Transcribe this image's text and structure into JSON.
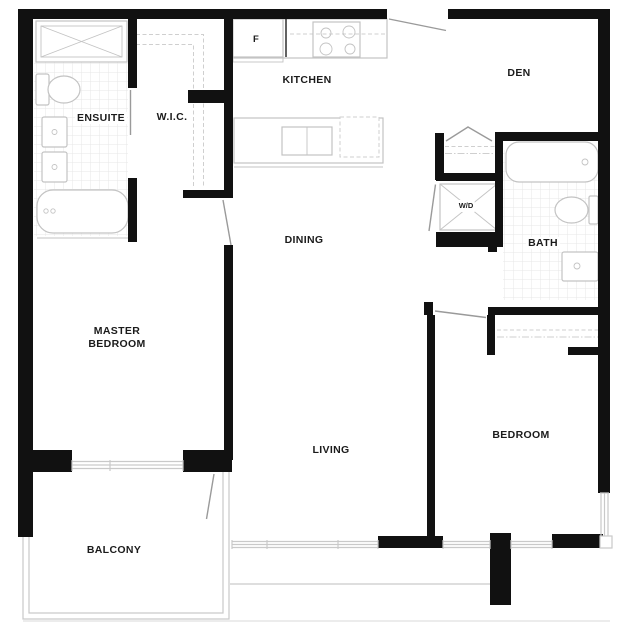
{
  "rooms": {
    "ensuite": "ENSUITE",
    "wic": "W.I.C.",
    "kitchen": "KITCHEN",
    "den": "DEN",
    "dining": "DINING",
    "bath": "BATH",
    "master_bedroom_line1": "MASTER",
    "master_bedroom_line2": "BEDROOM",
    "living": "LIVING",
    "bedroom": "BEDROOM",
    "balcony": "BALCONY"
  },
  "appliances": {
    "fridge": "F",
    "washer_dryer": "W/D"
  },
  "colors": {
    "wall": "#111111",
    "fixture": "#c3c3c3",
    "door": "#9a9a9a",
    "dash": "#cfcfcf",
    "tile": "#e7e7e7",
    "label": "#1b1b1b",
    "window": "#c9c9c9",
    "background": "#ffffff"
  }
}
